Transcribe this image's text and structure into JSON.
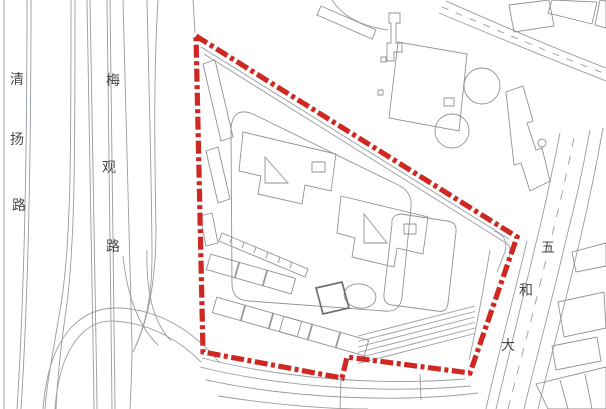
{
  "map": {
    "kind": "site location plan (CAD linework with red site boundary)",
    "background": "#ffffff"
  },
  "labels": {
    "road_left": {
      "name": "清扬路",
      "chars": [
        "清",
        "扬",
        "路"
      ]
    },
    "road_middle": {
      "name": "梅观路",
      "chars": [
        "梅",
        "观",
        "路"
      ]
    },
    "road_right": {
      "name": "五和大",
      "chars": [
        "五",
        "和",
        "大"
      ]
    }
  },
  "colors": {
    "boundary": "#cf2823",
    "linework": "#979ca0",
    "buildings": "#8e9397",
    "bold_building": "#6c7175",
    "label": "#44484c",
    "background": "#ffffff"
  },
  "boundary": {
    "style": "thick red dash-dot-dot site red-line",
    "vertices": [
      [
        196,
        36
      ],
      [
        517,
        237
      ],
      [
        470,
        373
      ],
      [
        347,
        357
      ],
      [
        342,
        378
      ],
      [
        203,
        352
      ]
    ]
  }
}
